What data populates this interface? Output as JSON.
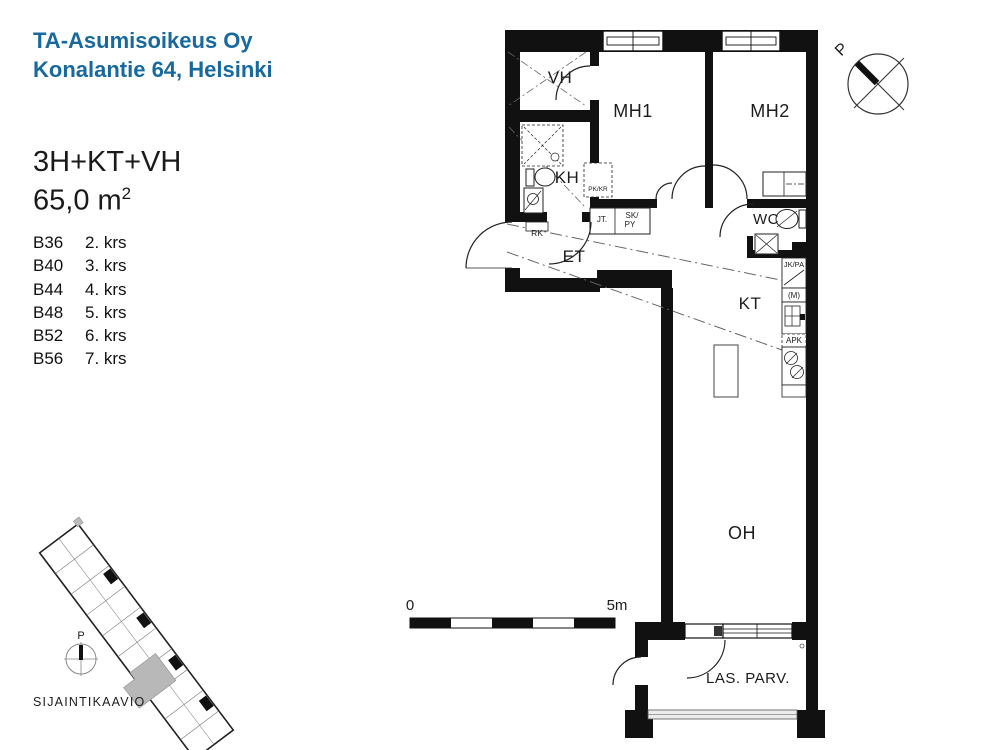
{
  "header": {
    "line1": "TA-Asumisoikeus Oy",
    "line2": "Konalantie 64, Helsinki"
  },
  "apartment": {
    "type": "3H+KT+VH",
    "area_base": "65,0 m",
    "area_exp": "2",
    "units": [
      {
        "id": "B36",
        "floor": "2. krs"
      },
      {
        "id": "B40",
        "floor": "3. krs"
      },
      {
        "id": "B44",
        "floor": "4. krs"
      },
      {
        "id": "B48",
        "floor": "5. krs"
      },
      {
        "id": "B52",
        "floor": "6. krs"
      },
      {
        "id": "B56",
        "floor": "7. krs"
      }
    ]
  },
  "plan": {
    "rooms": {
      "vh": "VH",
      "mh1": "MH1",
      "mh2": "MH2",
      "kh": "KH",
      "et": "ET",
      "wc": "WC",
      "kt": "KT",
      "oh": "OH",
      "balcony": "LAS. PARV."
    },
    "fixtures": {
      "pkkr": "PK/KR",
      "jt": "JT.",
      "sk": "SK/",
      "py": "PY",
      "rk": "RK",
      "jkpa": "JK/PA",
      "m": "(M)",
      "apk": "APK"
    },
    "scale": {
      "zero": "0",
      "five": "5m"
    },
    "north": "P"
  },
  "siteplan": {
    "title": "SIJAINTIKAAVIO",
    "north": "P"
  },
  "colors": {
    "brand_blue": "#17699e",
    "ink": "#1a1a1a",
    "highlight_gray": "#b8b8b8"
  }
}
